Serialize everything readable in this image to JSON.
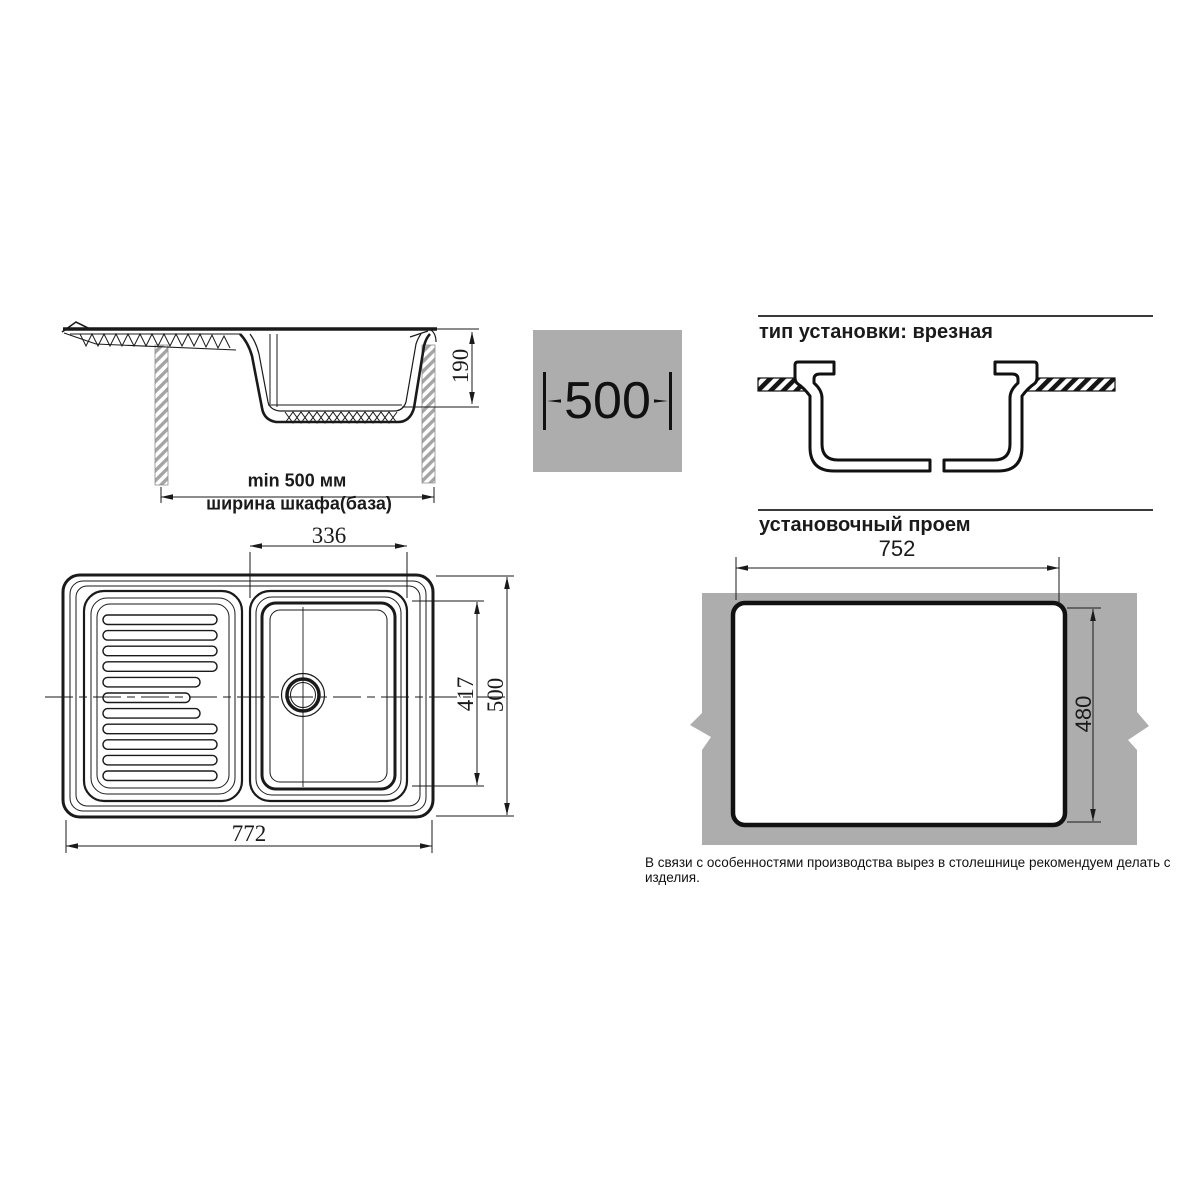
{
  "side_view": {
    "depth": "190",
    "min_width": "min 500 мм",
    "cabinet_width": "ширина шкафа(база)"
  },
  "cabinet_badge": {
    "width": "500"
  },
  "installation": {
    "title": "тип установки: врезная"
  },
  "top_view": {
    "bowl_width": "336",
    "bowl_depth": "417",
    "overall_depth": "500",
    "overall_width": "772"
  },
  "opening": {
    "title": "установочный проем",
    "width": "752",
    "height": "480"
  },
  "footnote": "В связи с особенностями производства вырез в столешнице рекомендуем делать с изделия.",
  "colors": {
    "gray": "#adadad",
    "line": "#1a1a1a"
  }
}
